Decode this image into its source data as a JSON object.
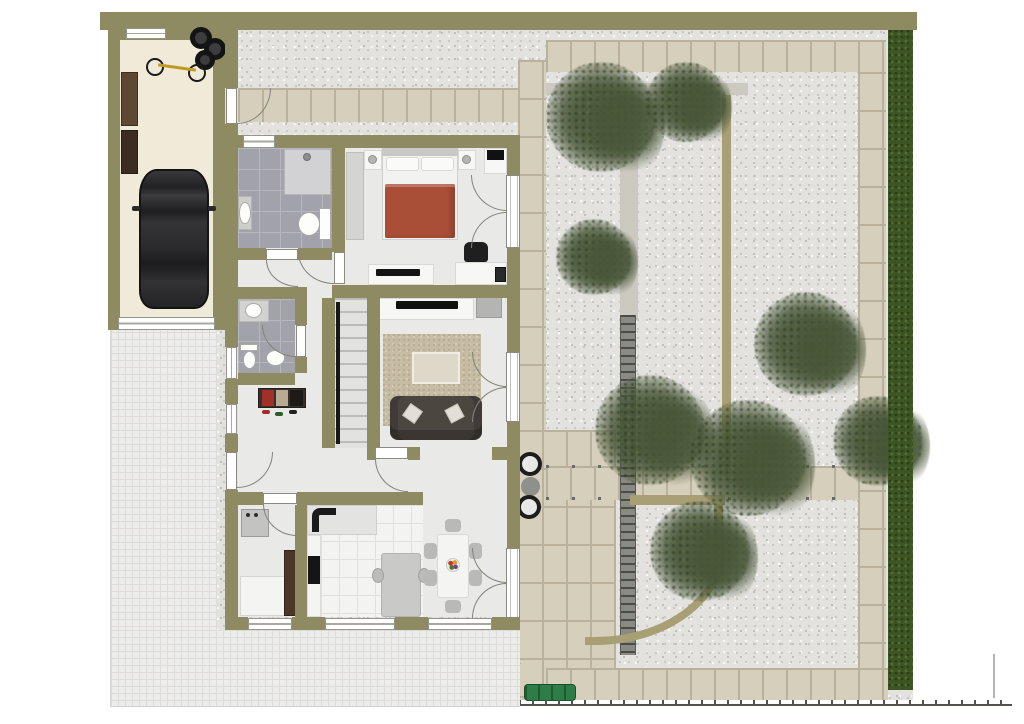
{
  "scene": {
    "kind": "residential-floor-plan-top-view",
    "visible_text": "",
    "areas": [
      "garage",
      "driveway",
      "entry-hall",
      "bathroom-top",
      "bathroom-lower",
      "bedroom",
      "living-room",
      "stair-hall",
      "kitchen",
      "dining-room",
      "utility-room",
      "terrace-patio",
      "gravel-garden",
      "hedge-border"
    ],
    "objects": {
      "garage": [
        "car",
        "bicycle",
        "spare-tires",
        "storage-shelf",
        "garage-door"
      ],
      "bedroom": [
        "double-bed-red-blanket",
        "nightstand-lamp-left",
        "nightstand-lamp-right",
        "wardrobe",
        "dresser-tv",
        "desk",
        "office-chair",
        "printer",
        "tv-lowboard"
      ],
      "living_room": [
        "tv-sideboard",
        "flat-tv",
        "area-rug",
        "coffee-table",
        "sofa-two-pillows",
        "stairs-with-rail",
        "french-door"
      ],
      "kitchen": [
        "l-shaped-counter",
        "corner-sink",
        "stove",
        "kitchen-island",
        "island-chairs"
      ],
      "dining_room": [
        "dining-table",
        "six-chairs",
        "fruit-bowl",
        "french-door"
      ],
      "bathroom_top": [
        "shower",
        "washbasin",
        "toilet",
        "window"
      ],
      "bathroom_lower": [
        "vanity-sink",
        "toilet",
        "hand-basin"
      ],
      "utility_room": [
        "washing-machine",
        "chest-freezer",
        "tall-cabinet"
      ],
      "hall": [
        "shoe-cabinet",
        "shoes",
        "entry-door"
      ],
      "garden": [
        "brick-paths",
        "gravel-beds",
        "trees",
        "pergola-trellis",
        "planter-pots",
        "green-bench",
        "hedge",
        "fence",
        "garden-gate"
      ]
    }
  },
  "colors": {
    "wall": "#8e8a62",
    "garage_floor": "#f0ead9",
    "floor": "#e9e9e7",
    "bath_tile": "#a2a2aa",
    "kitchen_tile": "#f3f3f1",
    "gravel": "#e3e2df",
    "brick": "#d5cfbc",
    "brick_gap": "#b9b19b",
    "paver": "#ececea",
    "hedge": "#3d5424",
    "tree": "#485638",
    "bed_blanket": "#a94e37",
    "sofa": "#4c4641",
    "rug": "#c6bca4",
    "stair_rail": "#181816",
    "fence": "#53524c",
    "edge_khaki": "#a89f74",
    "bench_green": "#2f7d46",
    "car_body": "#242426",
    "wood_cabinet": "#4a3729",
    "door_white": "#ffffff"
  }
}
